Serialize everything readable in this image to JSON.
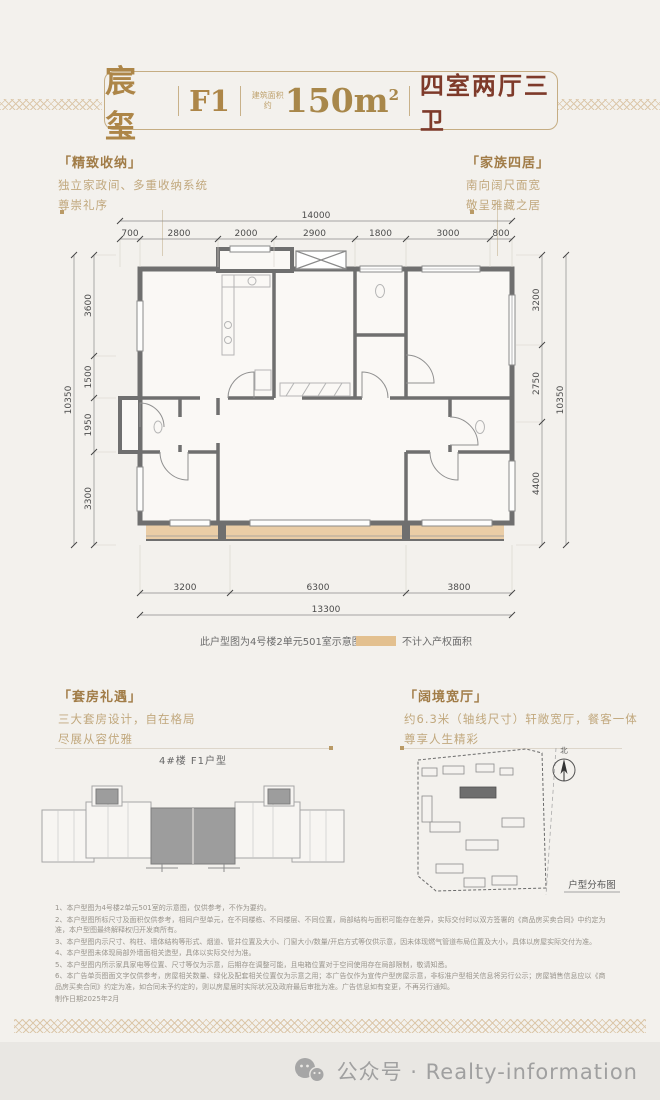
{
  "header": {
    "project_name": "宸玺",
    "unit": "F1",
    "area_label": "建筑面积约",
    "area_value": "150m",
    "area_sup": "2",
    "layout_text": "四室两厅三卫"
  },
  "features": {
    "top_left": {
      "header": "「精致收纳」",
      "line1": "独立家政间、多重收纳系统",
      "line2": "尊崇礼序"
    },
    "top_right": {
      "header": "「家族四居」",
      "line1": "南向阔尺面宽",
      "line2": "敬呈雅藏之居"
    },
    "bottom_left": {
      "header": "「套房礼遇」",
      "line1": "三大套房设计，自在格局",
      "line2": "尽展从容优雅"
    },
    "bottom_right": {
      "header": "「阔境宽厅」",
      "line1": "约6.3米（轴线尺寸）轩敞宽厅，餐客一体",
      "line2": "尊享人生精彩"
    }
  },
  "floorplan": {
    "total_top": "14000",
    "segments_top": [
      "700",
      "2800",
      "2000",
      "2900",
      "1800",
      "3000",
      "800"
    ],
    "total_left": "10350",
    "segments_left": [
      "3600",
      "1500",
      "1950",
      "3300"
    ],
    "total_right": "10350",
    "segments_right": [
      "3200",
      "2750",
      "4400"
    ],
    "total_bottom": "13300",
    "segments_bottom": [
      "3200",
      "6300",
      "3800"
    ],
    "caption": "此户型图为4号楼2单元501室示意图",
    "legend_label": "不计入产权面积",
    "legend_color": "#e3c08f",
    "wall_color": "#6f6f6f"
  },
  "keyplan": {
    "title": "4#楼 F1户型"
  },
  "siteplan": {
    "north_label": "北",
    "caption": "户型分布图"
  },
  "disclaimer": {
    "items": [
      "1、本户型图为4号楼2单元501室的示意图，仅供参考，不作为要约。",
      "2、本户型图所标尺寸及面积仅供参考，相同户型单元，在不同楼栋、不同楼层、不同位置，局部结构与面积可能存在差异，实际交付时以双方签署的《商品房买卖合同》中约定为准，本户型图最终解释权归开发商所有。",
      "3、本户型图内示尺寸、构柱、墙体结构等形式、烟道、管井位置及大小、门窗大小/数量/开启方式等仅供示意，因未体现燃气管道布局位置及大小，具体以房屋实际交付为准。",
      "4、本户型图未体现局部外墙面相关造型，具体以实际交付为准。",
      "5、本户型图内所示家具家电等位置、尺寸等仅为示意，后期存在调整可能，且电箱位置对于空间使用存在局部限制，敬请知悉。",
      "6、本广告单页图面文字仅供参考，房屋相关数量、绿化及配套相关位置仅为示意之用；本广告仅作为宣传户型房屋示意，非标准户型相关信息将另行公示；房屋销售信息应以《商品房买卖合同》约定为准，如合同未予约定的，则以房屋届时实际状况及政府最后审批为准。广告信息如有变更，不再另行通知。"
    ],
    "date": "制作日期2025年2月"
  },
  "footer": {
    "text": "公众号 · Realty-information"
  }
}
